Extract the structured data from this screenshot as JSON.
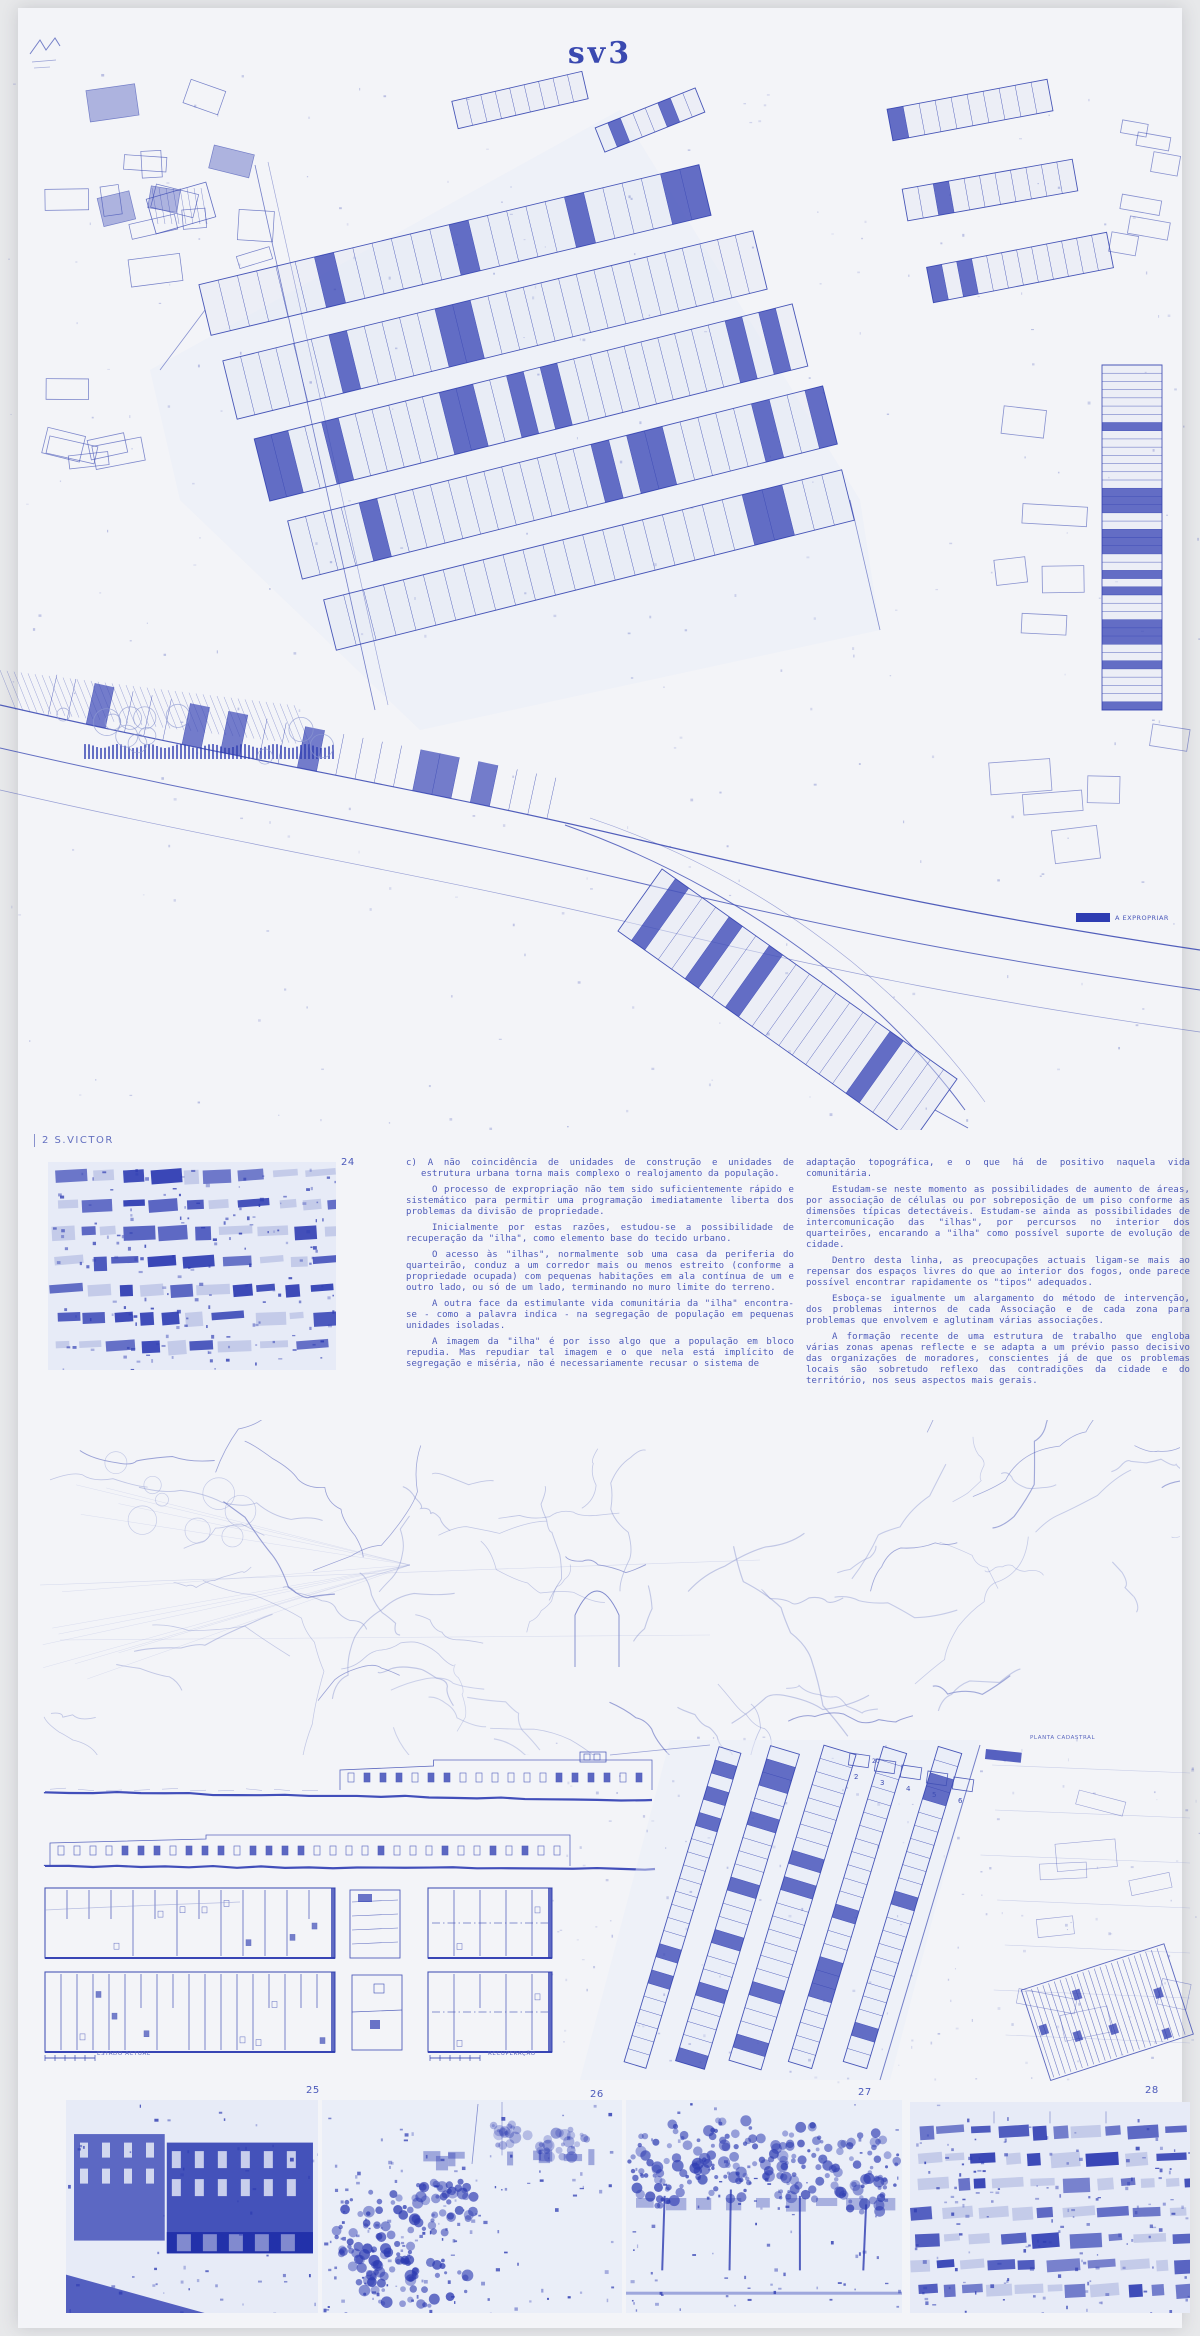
{
  "page": {
    "title": "sv3",
    "section_label": "2 S.VICTOR"
  },
  "map": {
    "legend_label": "A EXPROPRIAR",
    "legend_color": "#2e3cb2"
  },
  "figures": {
    "n24": "24",
    "n25": "25",
    "n26": "26",
    "n27": "27",
    "n28": "28"
  },
  "plans": {
    "estado_actual": "ESTADO ACTUAL",
    "recuperacao": "RECUPERAÇÃO",
    "planta_cadastral": "PLANTA CADASTRAL"
  },
  "cadastral": {
    "lots": [
      "2",
      "3",
      "4",
      "5",
      "6",
      "20"
    ]
  },
  "text": {
    "column1": [
      "c) A não coincidência de unidades de construção e unidades de estrutura urbana torna mais complexo o realojamento da população.",
      "O processo de expropriação não tem sido suficientemente rápido e sistemático para permitir uma programação imediatamente liberta dos problemas da divisão de propriedade.",
      "Inicialmente por estas razões, estudou-se a possibilidade de recuperação da \"ilha\", como elemento base do tecido urbano.",
      "O acesso às \"ilhas\", normalmente sob uma casa da periferia do quarteirão, conduz a um corredor mais ou menos estreito (conforme a propriedade ocupada) com pequenas habitações em ala contínua de um e outro lado, ou só de um lado, terminando no muro limite do terreno.",
      "A outra face da estimulante vida comunitária da \"ilha\" encontra-se - como a palavra indica - na segregação de população em pequenas unidades isoladas.",
      "A imagem da \"ilha\" é por isso algo que a população em bloco repudia. Mas repudiar tal imagem e o que nela está implícito de segregação e miséria, não é necessariamente recusar o sistema de"
    ],
    "column2": [
      "adaptação topográfica, e o que há de positivo naquela vida comunitária.",
      "Estudam-se neste momento as possibilidades de aumento de áreas, por associação de células ou por sobreposição de um piso conforme as dimensões típicas detectáveis. Estudam-se ainda as possibilidades de intercomunicação das \"ilhas\", por percursos no interior dos quarteirões, encarando a \"ilha\" como possível suporte de evolução de cidade.",
      "Dentro desta linha, as preocupações actuais ligam-se mais ao repensar dos espaços livres do que ao interior dos fogos, onde parece possível encontrar rapidamente os \"tipos\" adequados.",
      "Esboça-se igualmente um alargamento do método de intervenção, dos problemas internos de cada Associação e de cada zona para problemas que envolvem e aglutinam várias associações.",
      "A formação recente de uma estrutura de trabalho que engloba várias zonas apenas reflecte e se adapta a um prévio passo decisivo das organizações de moradores, conscientes já de que os problemas locais são sobretudo reflexo das contradições da cidade e do território, nos seus aspectos mais gerais."
    ]
  },
  "colors": {
    "ink": "#3f4eb4",
    "dark": "#2e3cb2",
    "light": "#8f9ad2",
    "wash": "#e2e7f5",
    "paper": "#f3f4f8",
    "text_blue": "#4d5ab9"
  }
}
